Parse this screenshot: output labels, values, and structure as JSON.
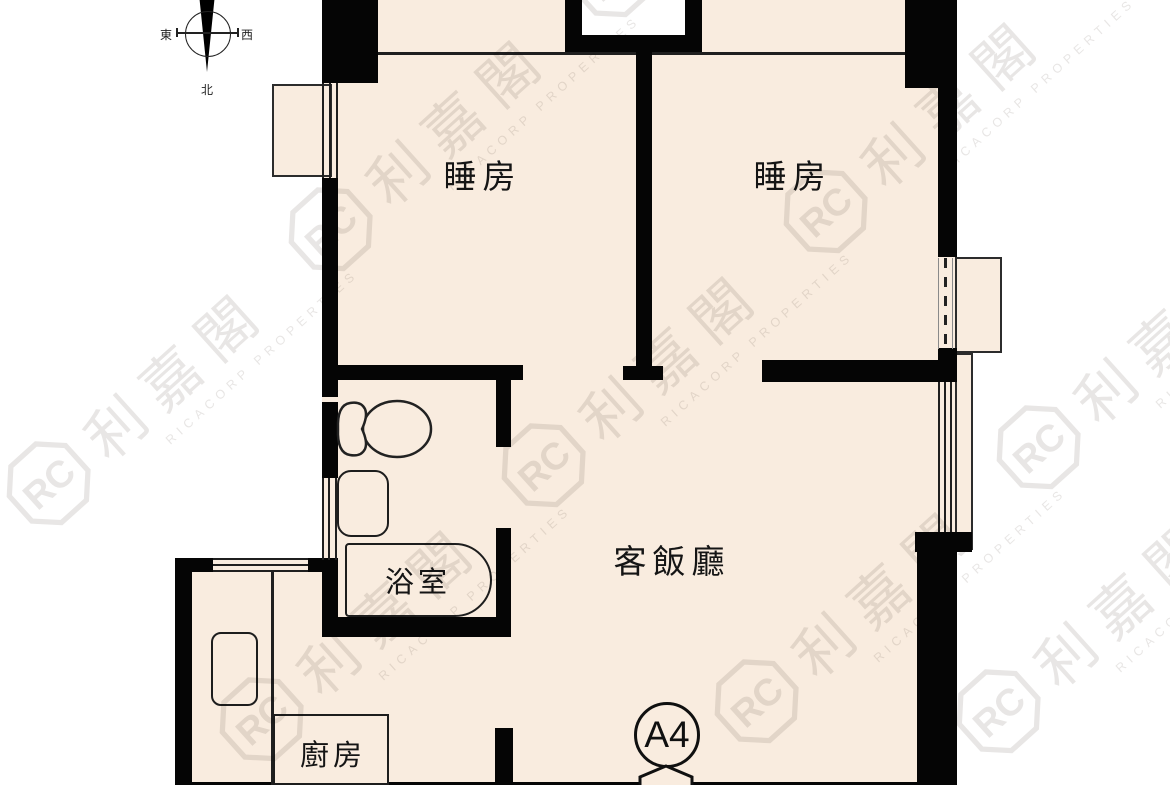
{
  "compass": {
    "east": "東",
    "west": "西",
    "north": "北"
  },
  "rooms": {
    "bedroom1": "睡房",
    "bedroom2": "睡房",
    "living_dining": "客飯廳",
    "bathroom": "浴室",
    "kitchen": "廚房"
  },
  "unit": {
    "label": "A4"
  },
  "watermark": {
    "cjk": "利嘉閣",
    "en": "RICACORP PROPERTIES",
    "monogram": "RC"
  },
  "colors": {
    "floor": "#f9ecdf",
    "wall": "#050505",
    "outside": "#ffffff"
  }
}
